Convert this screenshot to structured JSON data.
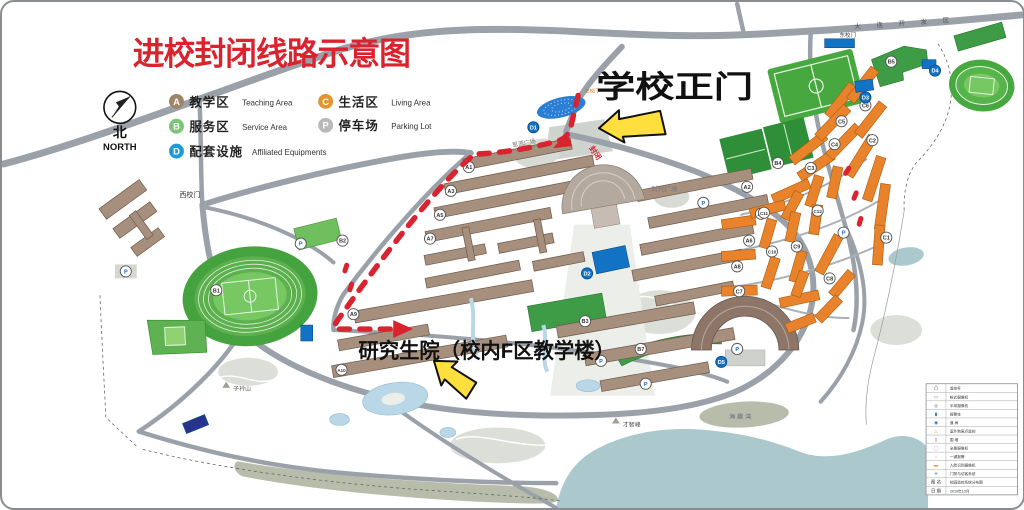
{
  "title": "进校封闭线路示意图",
  "compass": {
    "zh": "北",
    "en": "NORTH"
  },
  "colors": {
    "route": "#d9232e",
    "arrow": "#ffdf3d",
    "title": "#d9232e"
  },
  "legend": {
    "items": [
      {
        "letter": "A",
        "zh": "教学区",
        "en": "Teaching Area",
        "color": "#a08468"
      },
      {
        "letter": "B",
        "zh": "服务区",
        "en": "Service Area",
        "color": "#7cc576"
      },
      {
        "letter": "C",
        "zh": "生活区",
        "en": "Living Area",
        "color": "#e0952f"
      },
      {
        "letter": "P",
        "zh": "停车场",
        "en": "Parking Lot",
        "color": "#b9b9b9"
      },
      {
        "letter": "D",
        "zh": "配套设施",
        "en": "Affiliated Equipments",
        "color": "#1e9cd7"
      }
    ]
  },
  "labels": {
    "school_gate": "学校正门",
    "grad_school": "研究生院（校内F区教学楼）",
    "west_gate": "西校门",
    "east_gate": "东校门",
    "front_gate": "正校门",
    "siyuan_plaza": "思源广场",
    "times_plaza": "时代广场",
    "zijin_hill": "子衿山",
    "caizhi_hill": "才智峰",
    "bay": "海趣湾",
    "road_name": "大 连 开 发 区",
    "closed": "封闭"
  },
  "markers": [
    {
      "t": "A1",
      "x": 468,
      "y": 166,
      "k": "a"
    },
    {
      "t": "A3",
      "x": 450,
      "y": 190,
      "k": "a"
    },
    {
      "t": "A5",
      "x": 439,
      "y": 214,
      "k": "a"
    },
    {
      "t": "A7",
      "x": 429,
      "y": 238,
      "k": "a"
    },
    {
      "t": "A9",
      "x": 352,
      "y": 314,
      "k": "a"
    },
    {
      "t": "A2",
      "x": 748,
      "y": 186,
      "k": "a"
    },
    {
      "t": "A4",
      "x": 762,
      "y": 213,
      "k": "a"
    },
    {
      "t": "A6",
      "x": 750,
      "y": 240,
      "k": "a"
    },
    {
      "t": "A8",
      "x": 738,
      "y": 266,
      "k": "a"
    },
    {
      "t": "A10",
      "x": 340,
      "y": 370,
      "k": "a"
    },
    {
      "t": "B1",
      "x": 214,
      "y": 290,
      "k": "b"
    },
    {
      "t": "B2",
      "x": 341,
      "y": 240,
      "k": "b"
    },
    {
      "t": "B3",
      "x": 585,
      "y": 321,
      "k": "b"
    },
    {
      "t": "B4",
      "x": 779,
      "y": 162,
      "k": "b"
    },
    {
      "t": "B5",
      "x": 893,
      "y": 60,
      "k": "b"
    },
    {
      "t": "B7",
      "x": 641,
      "y": 349,
      "k": "b"
    },
    {
      "t": "C1",
      "x": 888,
      "y": 237,
      "k": "c"
    },
    {
      "t": "C2",
      "x": 874,
      "y": 139,
      "k": "c"
    },
    {
      "t": "C3",
      "x": 812,
      "y": 167,
      "k": "c"
    },
    {
      "t": "C4",
      "x": 836,
      "y": 143,
      "k": "c"
    },
    {
      "t": "C5",
      "x": 843,
      "y": 120,
      "k": "c"
    },
    {
      "t": "C6",
      "x": 867,
      "y": 104,
      "k": "c"
    },
    {
      "t": "C7",
      "x": 740,
      "y": 291,
      "k": "c"
    },
    {
      "t": "C8",
      "x": 831,
      "y": 278,
      "k": "c"
    },
    {
      "t": "C9",
      "x": 798,
      "y": 246,
      "k": "c"
    },
    {
      "t": "C10",
      "x": 773,
      "y": 251,
      "k": "c"
    },
    {
      "t": "C11",
      "x": 765,
      "y": 212,
      "k": "c"
    },
    {
      "t": "C12",
      "x": 819,
      "y": 210,
      "k": "c"
    },
    {
      "t": "D1",
      "x": 533,
      "y": 126,
      "k": "d"
    },
    {
      "t": "D2",
      "x": 587,
      "y": 273,
      "k": "d"
    },
    {
      "t": "D3",
      "x": 867,
      "y": 96,
      "k": "d"
    },
    {
      "t": "D4",
      "x": 937,
      "y": 69,
      "k": "d"
    },
    {
      "t": "D5",
      "x": 722,
      "y": 362,
      "k": "d"
    },
    {
      "t": "P",
      "x": 123,
      "y": 271,
      "k": "p"
    },
    {
      "t": "P",
      "x": 299,
      "y": 243,
      "k": "p"
    },
    {
      "t": "P",
      "x": 704,
      "y": 202,
      "k": "p"
    },
    {
      "t": "P",
      "x": 646,
      "y": 384,
      "k": "p"
    },
    {
      "t": "P",
      "x": 738,
      "y": 349,
      "k": "p"
    },
    {
      "t": "P",
      "x": 601,
      "y": 361,
      "k": "p"
    },
    {
      "t": "P",
      "x": 845,
      "y": 232,
      "k": "p"
    }
  ],
  "info_table": {
    "rows": [
      [
        "凸",
        "监控杆",
        "#6b7075"
      ],
      [
        "▭",
        "枪式摄像机",
        "#6b7075"
      ],
      [
        "◎",
        "半球摄像机",
        "#6b7075"
      ],
      [
        "▮",
        "报警柱",
        "#1273c4"
      ],
      [
        "◉",
        "道 闸",
        "#1273c4"
      ],
      [
        "△",
        "室外制高点监控",
        "#d9b23d"
      ],
      [
        "▯",
        "围 墙",
        "#d9232e"
      ],
      [
        "◯",
        "全景摄像机",
        "#d98fd9"
      ],
      [
        "○",
        "一键报警",
        "#e8a23d"
      ],
      [
        "▬",
        "人脸识别摄像机",
        "#e8832b"
      ],
      [
        "✛",
        "门禁与访客系统",
        "#1273c4"
      ],
      [
        "图 名",
        "校园监控系统分布图",
        "#333333"
      ],
      [
        "日 期",
        "2019年10月",
        "#333333"
      ]
    ]
  }
}
